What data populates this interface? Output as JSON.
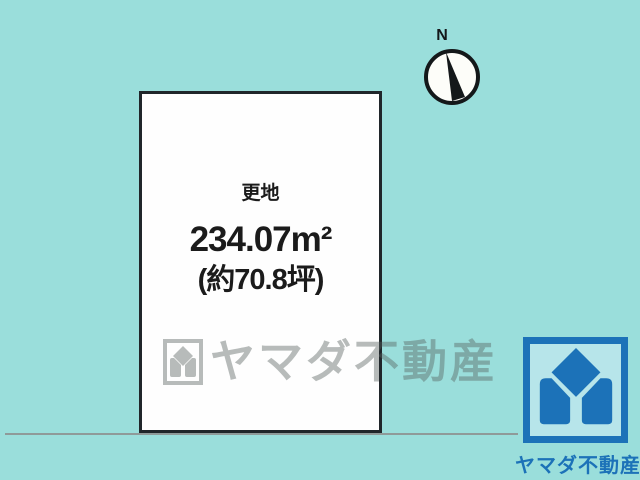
{
  "scene": {
    "background_color": "#9adedb",
    "road_line_color": "#8f9a99",
    "plot_border_color": "#20262a",
    "plot_fill_color": "#fefefe"
  },
  "plot": {
    "status_label": "更地",
    "area_m2": "234.07m²",
    "area_tsubo": "(約70.8坪)"
  },
  "compass": {
    "north_label": "N"
  },
  "watermark": {
    "text": "ヤマダ不動産"
  },
  "brand": {
    "name": "ヤマダ不動産",
    "color": "#1c72b8"
  }
}
